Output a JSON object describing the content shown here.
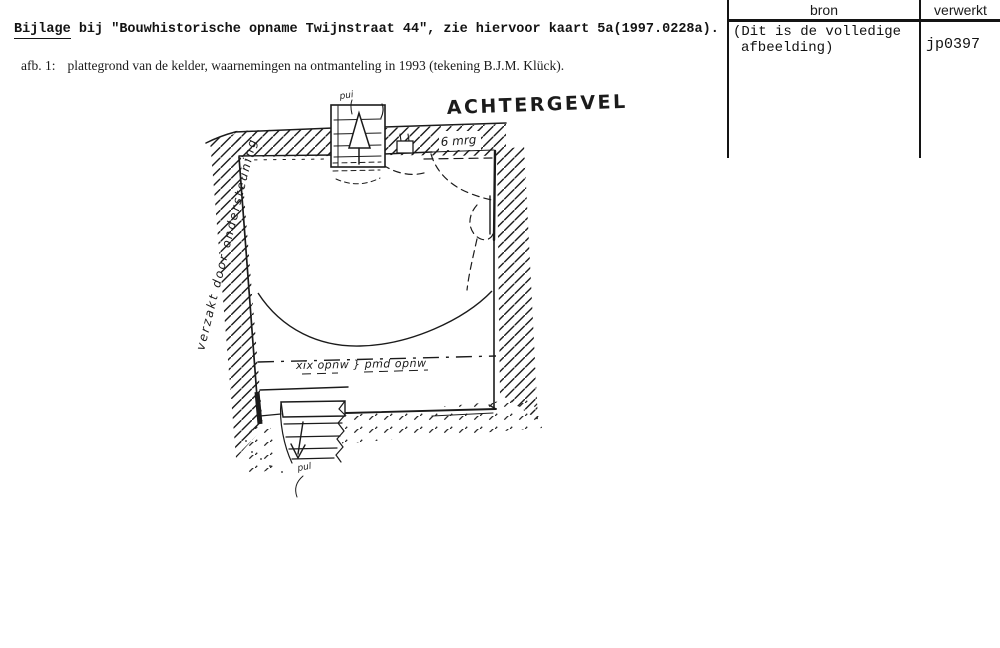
{
  "header": {
    "title_word": "Bijlage",
    "title_rest": " bij \"Bouwhistorische opname Twijnstraat 44\", zie hiervoor kaart 5a(1997.0228a).",
    "caption_label": "afb. 1:",
    "caption_text": "plattegrond van de kelder, waarnemingen na ontmanteling in 1993 (tekening B.J.M. Klück)."
  },
  "table": {
    "col1_header": "bron",
    "col2_header": "verwerkt",
    "col1_value_line1": "(Dit is de volledige",
    "col1_value_line2": "afbeelding)",
    "col2_value": "jp0397"
  },
  "sketch": {
    "gable_label": "ACHTERGEVEL",
    "wall_note": "6 mrg",
    "shaft_note": "pui",
    "left_note": "verzakt door ondersteuning",
    "dashline_note": "xix opnw } pmd opnw",
    "stair_note": "pul"
  },
  "colors": {
    "ink": "#1b1b1b",
    "paper": "#ffffff"
  }
}
